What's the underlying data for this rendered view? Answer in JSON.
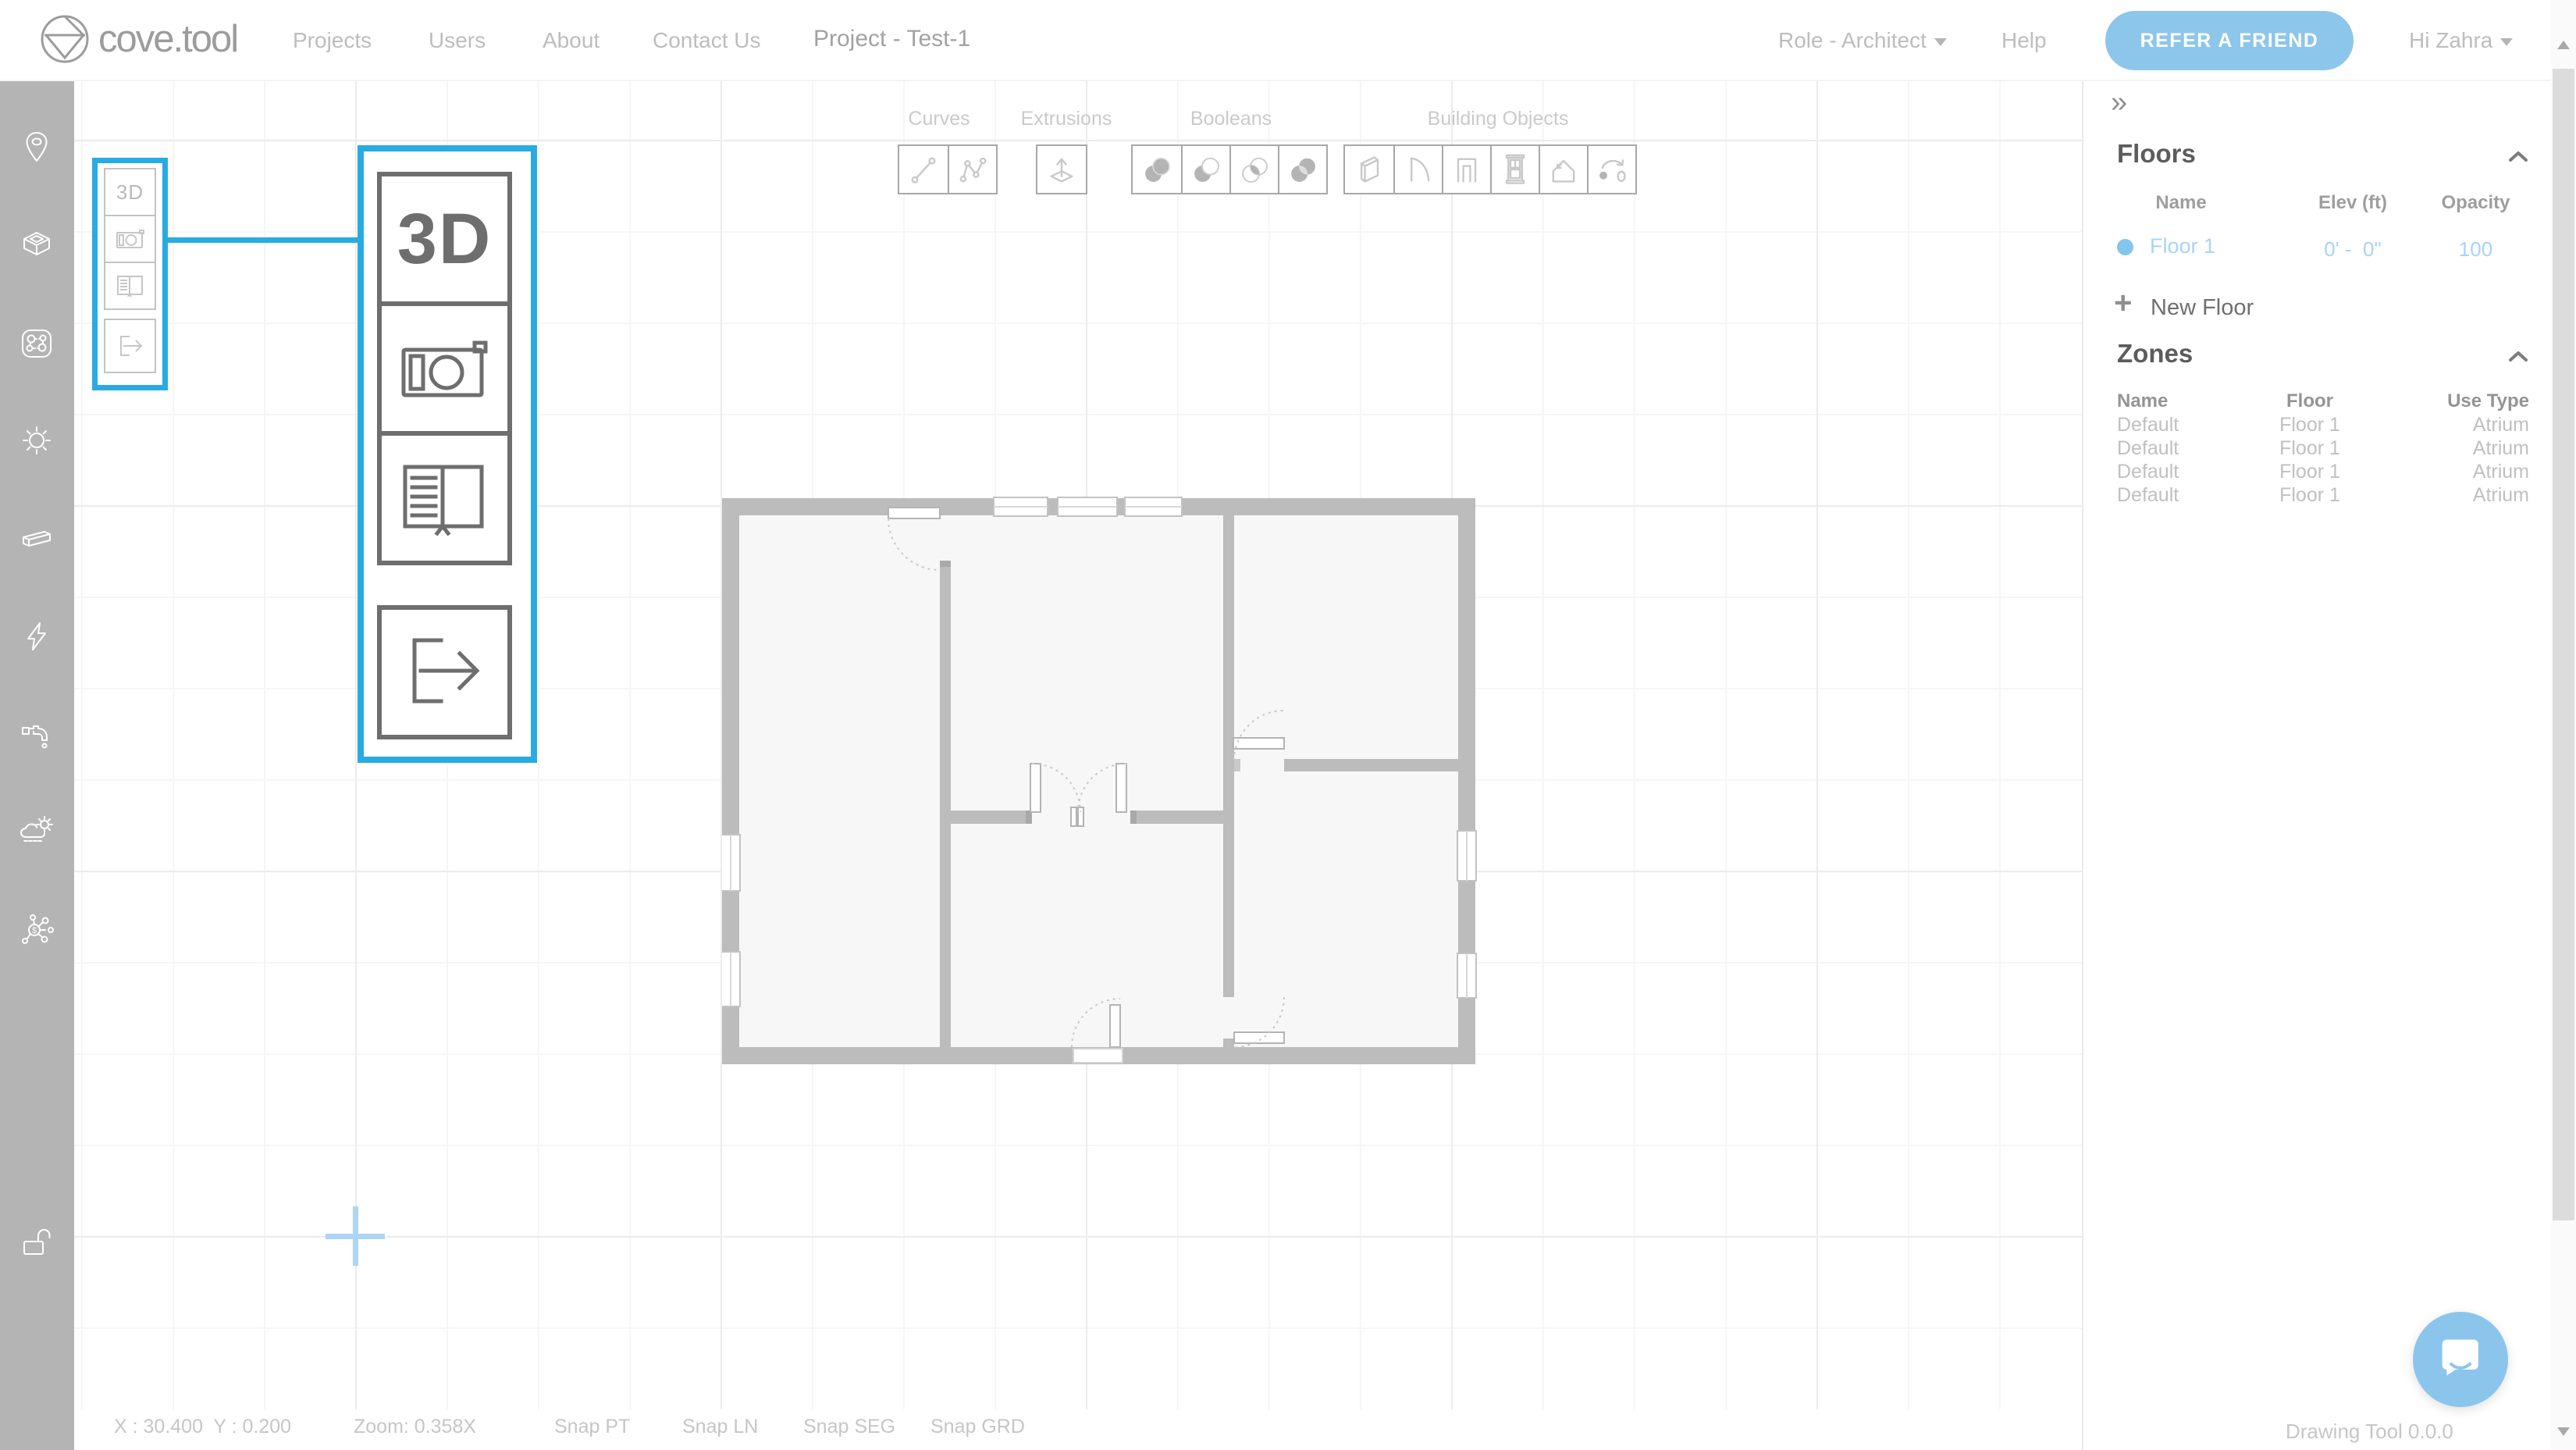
{
  "colors": {
    "accent_blue": "#29abe2",
    "brand_blue": "#8cc5ea",
    "selection_blue": "#aed5f4",
    "sidebar_gray": "#b4b4b4",
    "wall_gray": "#bcbcbc"
  },
  "nav": {
    "logo": "cove.tool",
    "links": [
      "Projects",
      "Users",
      "About",
      "Contact Us"
    ],
    "project": "Project - Test-1",
    "role": "Role - Architect",
    "help": "Help",
    "refer": "REFER A FRIEND",
    "user": "Hi Zahra"
  },
  "sidebar": {
    "tools": [
      {
        "icon": "location-pin"
      },
      {
        "icon": "cube-3d"
      },
      {
        "icon": "massing-nodes"
      },
      {
        "icon": "sun"
      },
      {
        "icon": "wall-panel"
      },
      {
        "icon": "lightning-bolt"
      },
      {
        "icon": "water-faucet"
      },
      {
        "icon": "weather-cloud-sun"
      },
      {
        "icon": "network-dollar"
      },
      {
        "icon": "padlock-open"
      }
    ]
  },
  "palette": {
    "tools": [
      {
        "label": "3D",
        "icon": "3d-view"
      },
      {
        "icon": "camera-snapshot"
      },
      {
        "icon": "open-book"
      },
      {
        "icon": "export-arrow"
      }
    ]
  },
  "toolbar": {
    "groups": [
      {
        "label": "Curves",
        "tools": [
          "line",
          "polyline"
        ]
      },
      {
        "label": "Extrusions",
        "tools": [
          "extrude"
        ]
      },
      {
        "label": "Booleans",
        "tools": [
          "union",
          "difference",
          "intersection",
          "combine"
        ]
      },
      {
        "label": "Building Objects",
        "tools": [
          "wall-panel",
          "curved-wall",
          "door-frame",
          "window",
          "roof",
          "rotate-copy"
        ]
      }
    ]
  },
  "floors_panel": {
    "collapse_icon": "»",
    "title": "Floors",
    "headers": [
      "Name",
      "Elev (ft)",
      "Opacity"
    ],
    "rows": [
      {
        "name": "Floor 1",
        "elev": "0' -  0\"",
        "opacity": "100"
      }
    ],
    "add_icon": "+",
    "add_label": "New Floor"
  },
  "zones_panel": {
    "title": "Zones",
    "headers": [
      "Name",
      "Floor",
      "Use Type"
    ],
    "rows": [
      {
        "name": "Default",
        "floor": "Floor 1",
        "use_type": "Atrium"
      },
      {
        "name": "Default",
        "floor": "Floor 1",
        "use_type": "Atrium"
      },
      {
        "name": "Default",
        "floor": "Floor 1",
        "use_type": "Atrium"
      },
      {
        "name": "Default",
        "floor": "Floor 1",
        "use_type": "Atrium"
      }
    ]
  },
  "statusbar": {
    "coordinates": "X : 30.400  Y : 0.200",
    "zoom": "Zoom: 0.358X",
    "snaps": [
      "Snap PT",
      "Snap LN",
      "Snap SEG",
      "Snap GRD"
    ],
    "version": "Drawing Tool 0.0.0"
  }
}
